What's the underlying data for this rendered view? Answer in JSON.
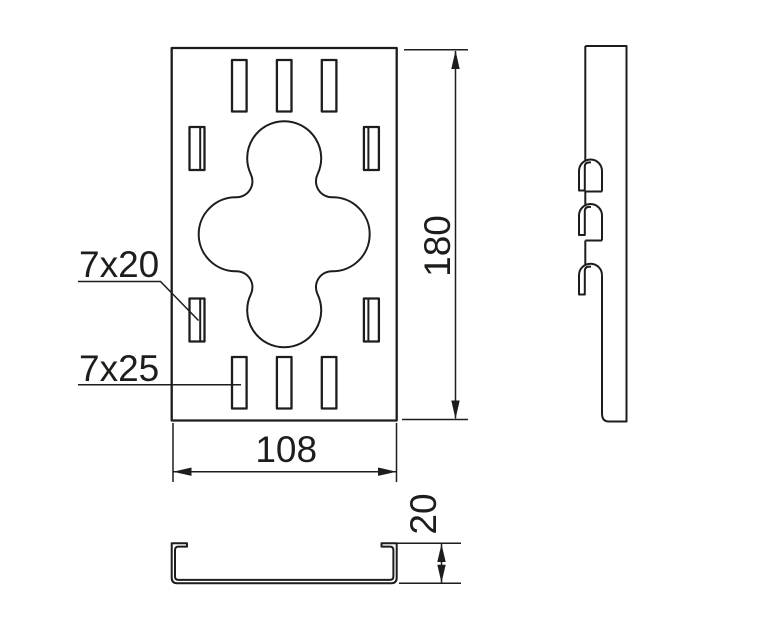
{
  "drawing": {
    "type": "technical-drawing",
    "colors": {
      "line": "#1d1d1b",
      "background": "#ffffff"
    },
    "labels": {
      "slot_small": "7x20",
      "slot_large": "7x25"
    },
    "dimensions": {
      "height": "180",
      "width": "108",
      "depth": "20"
    }
  }
}
